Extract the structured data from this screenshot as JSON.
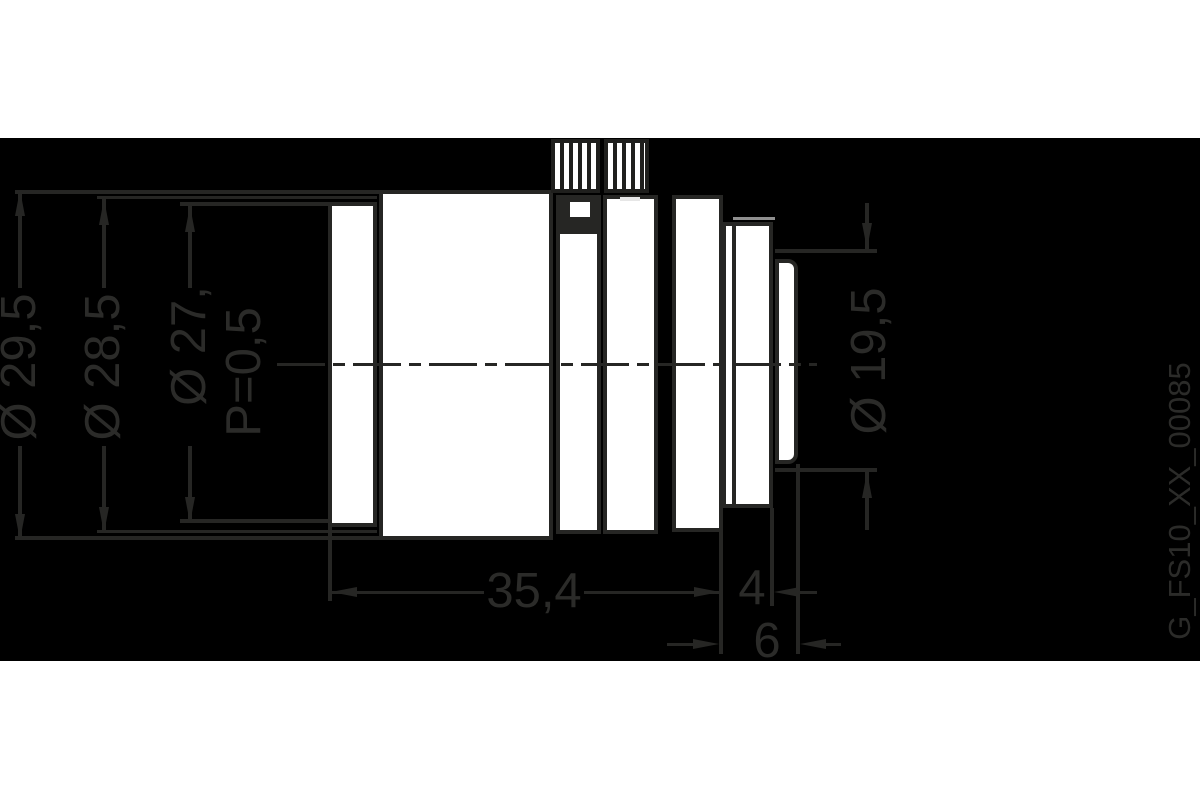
{
  "drawing": {
    "id_label": "G_FS10_XX_00085",
    "labels": {
      "d295": "Ø 29,5",
      "d285": "Ø 28,5",
      "d27": "Ø 27,",
      "p05": "P=0,5",
      "d195": "Ø 19,5",
      "d354": "35,4",
      "d4": "4",
      "d6": "6"
    },
    "colors": {
      "page_background": "#ffffff",
      "panel_background": "#000000",
      "ink": "#262624",
      "part_fill": "#ffffff",
      "highlight_line": "#8f8f8f",
      "iris_dash": "#e6e6e6"
    },
    "geometry": {
      "panel": {
        "x": 0,
        "y": 138,
        "w": 1200,
        "h": 523
      },
      "centerline": {
        "x": 277,
        "y": 363,
        "w": 540
      },
      "parts": [
        {
          "name": "front-ring",
          "x": 328,
          "y": 202,
          "w": 49,
          "h": 325
        },
        {
          "name": "main-barrel",
          "x": 379,
          "y": 190,
          "w": 174,
          "h": 350
        },
        {
          "name": "focus-ring",
          "x": 556,
          "y": 195,
          "w": 45,
          "h": 339
        },
        {
          "name": "iris-ring",
          "x": 603,
          "y": 195,
          "w": 55,
          "h": 339
        },
        {
          "name": "rear-barrel",
          "x": 672,
          "y": 195,
          "w": 51,
          "h": 337
        },
        {
          "name": "mount-flange",
          "x": 722,
          "y": 222,
          "w": 51,
          "h": 286
        },
        {
          "name": "rear-thread-section",
          "x": 775,
          "y": 259,
          "w": 23,
          "h": 205,
          "round_right": 10
        }
      ],
      "knobs": [
        {
          "name": "focus-knurled-knob",
          "x": 551,
          "y": 139,
          "w": 49,
          "h": 54
        },
        {
          "name": "iris-knurled-knob",
          "x": 604,
          "y": 139,
          "w": 45,
          "h": 54
        }
      ],
      "dark_rects": [
        {
          "name": "set-screw-block",
          "x": 558,
          "y": 195,
          "w": 43,
          "h": 39
        },
        {
          "name": "flange-inner-line",
          "x": 732,
          "y": 222,
          "w": 4,
          "h": 286
        }
      ],
      "white_rects": [
        {
          "name": "set-screw-head",
          "x": 570,
          "y": 202,
          "w": 20,
          "h": 15
        }
      ],
      "highlight_lines": [
        {
          "name": "flange-top-highlight",
          "x": 733,
          "y": 217,
          "w": 42,
          "h": 3,
          "color": "highlight_line"
        },
        {
          "name": "iris-top-dash",
          "x": 620,
          "y": 197,
          "w": 20,
          "h": 4,
          "color": "iris_dash"
        }
      ],
      "ink_lines": [
        {
          "name": "ext-29-top",
          "x": 15,
          "y": 190,
          "w": 364,
          "h": 4
        },
        {
          "name": "ext-29-bottom",
          "x": 15,
          "y": 536,
          "w": 364,
          "h": 4
        },
        {
          "name": "shaft-29-upper",
          "x": 18,
          "y": 190,
          "w": 4,
          "h": 98
        },
        {
          "name": "shaft-29-lower",
          "x": 18,
          "y": 446,
          "w": 4,
          "h": 94
        },
        {
          "name": "ext-285-top",
          "x": 97,
          "y": 196,
          "w": 280,
          "h": 3
        },
        {
          "name": "ext-285-bottom",
          "x": 97,
          "y": 530,
          "w": 280,
          "h": 3
        },
        {
          "name": "shaft-285-upper",
          "x": 102,
          "y": 199,
          "w": 4,
          "h": 89
        },
        {
          "name": "shaft-285-lower",
          "x": 102,
          "y": 446,
          "w": 4,
          "h": 87
        },
        {
          "name": "ext-27-top",
          "x": 180,
          "y": 202,
          "w": 150,
          "h": 4
        },
        {
          "name": "ext-27-bottom",
          "x": 180,
          "y": 519,
          "w": 150,
          "h": 4
        },
        {
          "name": "shaft-27-upper",
          "x": 188,
          "y": 206,
          "w": 4,
          "h": 82
        },
        {
          "name": "shaft-27-lower",
          "x": 188,
          "y": 446,
          "w": 4,
          "h": 77
        },
        {
          "name": "ext-195-top",
          "x": 775,
          "y": 249,
          "w": 102,
          "h": 4
        },
        {
          "name": "ext-195-bottom",
          "x": 775,
          "y": 468,
          "w": 102,
          "h": 4
        },
        {
          "name": "shaft-195-upper",
          "x": 865,
          "y": 203,
          "w": 4,
          "h": 46
        },
        {
          "name": "shaft-195-lower",
          "x": 865,
          "y": 472,
          "w": 4,
          "h": 58
        },
        {
          "name": "ext-vert-354-left",
          "x": 328,
          "y": 527,
          "w": 4,
          "h": 74
        },
        {
          "name": "ext-vert-flange-left",
          "x": 719,
          "y": 508,
          "w": 4,
          "h": 146
        },
        {
          "name": "ext-vert-flange-right",
          "x": 770,
          "y": 508,
          "w": 4,
          "h": 98
        },
        {
          "name": "ext-vert-rear-tip",
          "x": 796,
          "y": 464,
          "w": 4,
          "h": 190
        },
        {
          "name": "dim-354-line-left",
          "x": 331,
          "y": 591,
          "w": 153,
          "h": 3
        },
        {
          "name": "dim-354-line-right",
          "x": 584,
          "y": 591,
          "w": 136,
          "h": 3
        },
        {
          "name": "dim-4-tail-right",
          "x": 800,
          "y": 591,
          "w": 17,
          "h": 3
        },
        {
          "name": "dim-6-tail-left",
          "x": 667,
          "y": 643,
          "w": 27,
          "h": 3
        },
        {
          "name": "dim-6-tail-right",
          "x": 826,
          "y": 643,
          "w": 15,
          "h": 3
        }
      ],
      "arrows": [
        {
          "name": "arrow-29-up",
          "tipx": 20,
          "tipy": 190,
          "dir": "up"
        },
        {
          "name": "arrow-29-down",
          "tipx": 20,
          "tipy": 540,
          "dir": "down"
        },
        {
          "name": "arrow-285-up",
          "tipx": 104,
          "tipy": 199,
          "dir": "up"
        },
        {
          "name": "arrow-285-down",
          "tipx": 104,
          "tipy": 533,
          "dir": "down"
        },
        {
          "name": "arrow-27-up",
          "tipx": 190,
          "tipy": 206,
          "dir": "up"
        },
        {
          "name": "arrow-27-down",
          "tipx": 190,
          "tipy": 523,
          "dir": "down"
        },
        {
          "name": "arrow-195-down",
          "tipx": 867,
          "tipy": 249,
          "dir": "down"
        },
        {
          "name": "arrow-195-up",
          "tipx": 867,
          "tipy": 472,
          "dir": "up"
        },
        {
          "name": "arrow-354-left",
          "tipx": 331,
          "tipy": 592,
          "dir": "left"
        },
        {
          "name": "arrow-354-right",
          "tipx": 720,
          "tipy": 592,
          "dir": "right"
        },
        {
          "name": "arrow-4-left",
          "tipx": 774,
          "tipy": 592,
          "dir": "left"
        },
        {
          "name": "arrow-6-right",
          "tipx": 719,
          "tipy": 644,
          "dir": "right"
        },
        {
          "name": "arrow-6-left",
          "tipx": 800,
          "tipy": 644,
          "dir": "left"
        }
      ],
      "texts": [
        {
          "key": "d295",
          "x": 20,
          "y": 367,
          "rot": true,
          "size": 49
        },
        {
          "key": "d285",
          "x": 104,
          "y": 367,
          "rot": true,
          "size": 49
        },
        {
          "key": "d27",
          "x": 190,
          "y": 346,
          "rot": true,
          "size": 49
        },
        {
          "key": "p05",
          "x": 245,
          "y": 372,
          "rot": true,
          "size": 49
        },
        {
          "key": "d195",
          "x": 870,
          "y": 361,
          "rot": true,
          "size": 49
        },
        {
          "key": "d354",
          "x": 534,
          "y": 592,
          "rot": false,
          "size": 49
        },
        {
          "key": "d4",
          "x": 752,
          "y": 589,
          "rot": false,
          "size": 49
        },
        {
          "key": "d6",
          "x": 767,
          "y": 642,
          "rot": false,
          "size": 49
        },
        {
          "key": "caption",
          "x": 1180,
          "y": 501,
          "rot": true,
          "size": 31
        }
      ]
    }
  }
}
